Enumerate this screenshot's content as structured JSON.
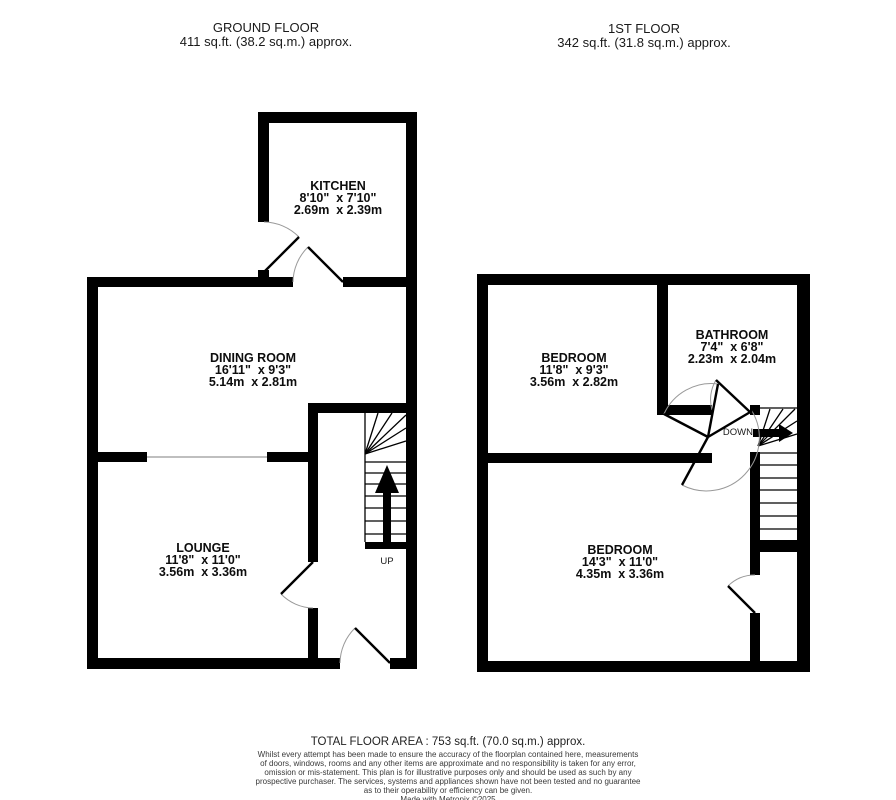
{
  "page": {
    "background_color": "#ffffff",
    "wall_color": "#000000",
    "door_swing_color": "#999999"
  },
  "ground_floor": {
    "title": "GROUND FLOOR",
    "area": "411 sq.ft. (38.2 sq.m.) approx.",
    "rooms": [
      {
        "name": "KITCHEN",
        "imperial": "8'10\"  x 7'10\"",
        "metric": "2.69m  x 2.39m"
      },
      {
        "name": "DINING ROOM",
        "imperial": "16'11\"  x 9'3\"",
        "metric": "5.14m  x 2.81m"
      },
      {
        "name": "LOUNGE",
        "imperial": "11'8\"  x 11'0\"",
        "metric": "3.56m  x 3.36m"
      }
    ],
    "stair_label": "UP"
  },
  "first_floor": {
    "title": "1ST FLOOR",
    "area": "342 sq.ft. (31.8 sq.m.) approx.",
    "rooms": [
      {
        "name": "BEDROOM",
        "imperial": "11'8\"  x 9'3\"",
        "metric": "3.56m  x 2.82m"
      },
      {
        "name": "BATHROOM",
        "imperial": "7'4\"  x 6'8\"",
        "metric": "2.23m  x 2.04m"
      },
      {
        "name": "BEDROOM",
        "imperial": "14'3\"  x 11'0\"",
        "metric": "4.35m  x 3.36m"
      }
    ],
    "stair_label": "DOWN"
  },
  "footer": {
    "total_area": "TOTAL FLOOR AREA : 753 sq.ft. (70.0 sq.m.) approx.",
    "disclaimer_lines": [
      "Whilst every attempt has been made to ensure the accuracy of the floorplan contained here, measurements",
      "of doors, windows, rooms and any other items are approximate and no responsibility is taken for any error,",
      "omission or mis-statement. This plan is for illustrative purposes only and should be used as such by any",
      "prospective purchaser. The services, systems and appliances shown have not been tested and no guarantee",
      "as to their operability or efficiency can be given."
    ],
    "credit": "Made with Metropix ©2025"
  }
}
